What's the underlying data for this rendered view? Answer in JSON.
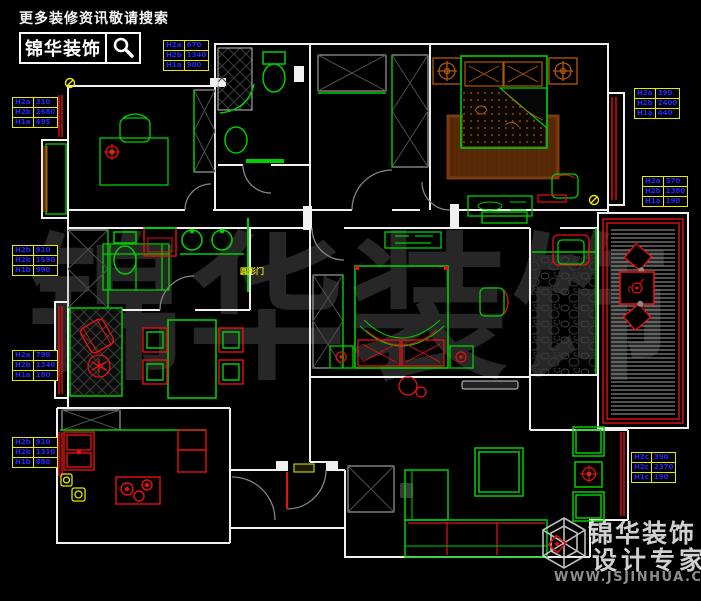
{
  "header": {
    "tagline": "更多装修资讯敬请搜索",
    "brand": "锦华装饰"
  },
  "watermark": {
    "text": "锦华装饰"
  },
  "footer": {
    "brand": "锦华装饰",
    "slogan": "设计专家",
    "url": "WWW.JSJINHUA.COM"
  },
  "plan": {
    "arc_door_label": "圆形门",
    "colors": {
      "background": "#000000",
      "wall_white": "#f0f0f0",
      "furniture_green": "#00cf00",
      "accent_red": "#e81010",
      "bed_orange": "#b4560a",
      "rug_brown": "#7a3b10",
      "dim_table_border_yellow": "#e8e800",
      "dim_text_blue": "#2525ff",
      "hatch_gray": "#9f9f9f",
      "watermark_gray": "#272727"
    },
    "dim_tables": [
      {
        "pos": {
          "x": 163,
          "y": 40
        },
        "rows": [
          [
            "H2a",
            "670"
          ],
          [
            "H2b",
            "1340"
          ],
          [
            "H1a",
            "900"
          ]
        ]
      },
      {
        "pos": {
          "x": 12,
          "y": 97
        },
        "rows": [
          [
            "H2a",
            "310"
          ],
          [
            "H2b",
            "2680"
          ],
          [
            "H1a",
            "495"
          ]
        ]
      },
      {
        "pos": {
          "x": 12,
          "y": 245
        },
        "rows": [
          [
            "H2b",
            "910"
          ],
          [
            "H2b",
            "1590"
          ],
          [
            "H1b",
            "990"
          ]
        ]
      },
      {
        "pos": {
          "x": 12,
          "y": 350
        },
        "rows": [
          [
            "H2a",
            "790"
          ],
          [
            "H2b",
            "1340"
          ],
          [
            "H1a",
            "180"
          ]
        ]
      },
      {
        "pos": {
          "x": 12,
          "y": 437
        },
        "rows": [
          [
            "H2b",
            "910"
          ],
          [
            "H2b",
            "1310"
          ],
          [
            "H1b",
            "880"
          ]
        ]
      },
      {
        "pos": {
          "x": 634,
          "y": 88
        },
        "rows": [
          [
            "H2a",
            "390"
          ],
          [
            "H2b",
            "2400"
          ],
          [
            "H1a",
            "440"
          ]
        ]
      },
      {
        "pos": {
          "x": 642,
          "y": 176
        },
        "rows": [
          [
            "H2a",
            "570"
          ],
          [
            "H2b",
            "2380"
          ],
          [
            "H1a",
            "190"
          ]
        ]
      },
      {
        "pos": {
          "x": 631,
          "y": 452
        },
        "rows": [
          [
            "H2c",
            "390"
          ],
          [
            "H2c",
            "2370"
          ],
          [
            "H1c",
            "190"
          ]
        ]
      }
    ]
  }
}
